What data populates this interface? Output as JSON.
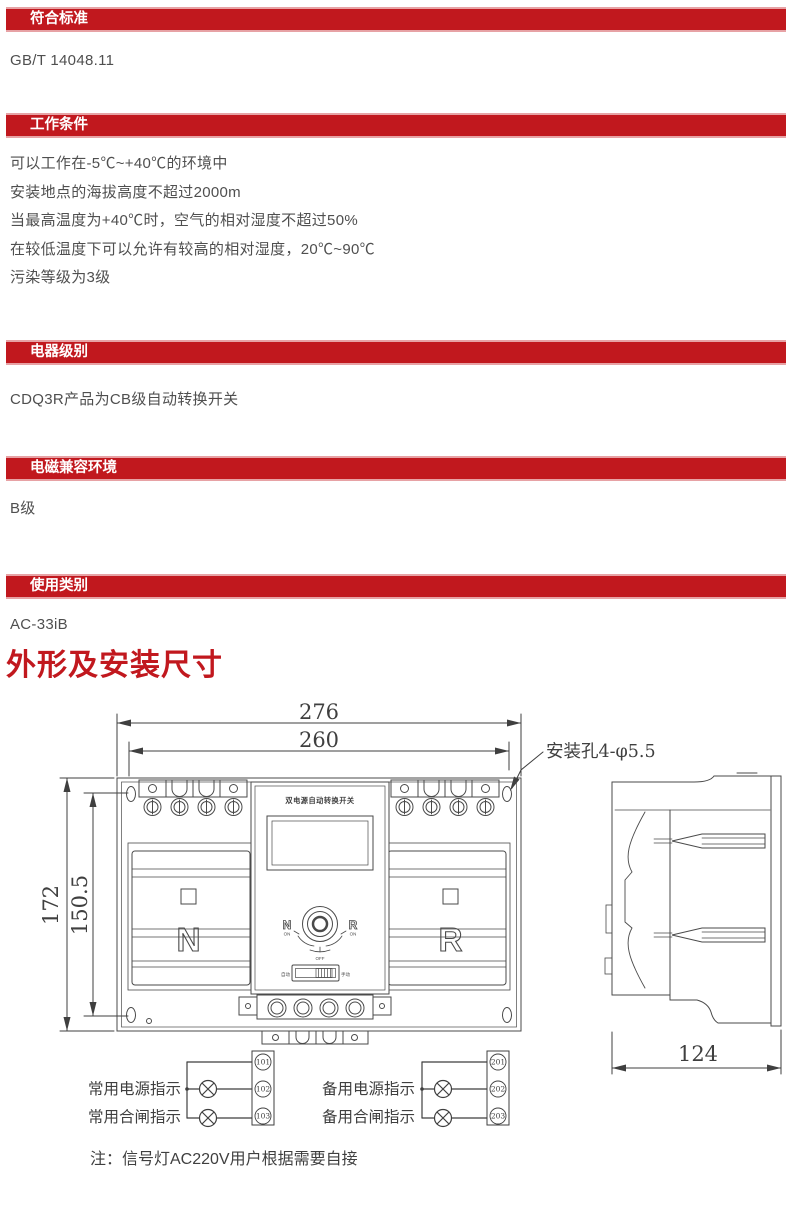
{
  "colors": {
    "accent_red": "#c1181e",
    "bar_edge": "#e7a2a5",
    "text_gray": "#4f4f4f",
    "line_gray": "#4a4a4a"
  },
  "sections": [
    {
      "label": "符合标准",
      "lines": [
        "GB/T 14048.11"
      ]
    },
    {
      "label": "工作条件",
      "lines": [
        "可以工作在-5℃~+40℃的环境中",
        "安装地点的海拔高度不超过2000m",
        "当最高温度为+40℃时，空气的相对湿度不超过50%",
        "在较低温度下可以允许有较高的相对湿度，20℃~90℃",
        "污染等级为3级"
      ]
    },
    {
      "label": "电器级别",
      "lines": [
        "CDQ3R产品为CB级自动转换开关"
      ]
    },
    {
      "label": "电磁兼容环境",
      "lines": [
        "B级"
      ]
    },
    {
      "label": "使用类别",
      "lines": [
        "AC-33iB"
      ]
    }
  ],
  "drawing_title": "外形及安装尺寸",
  "drawing": {
    "dimensions": {
      "width_outer": "276",
      "width_holes": "260",
      "height_outer": "172",
      "height_holes": "150.5",
      "depth": "124",
      "mounting_hole_label": "安装孔4-φ5.5"
    },
    "front_view": {
      "product_title": "双电源自动转换开关",
      "left_pole_letter": "N",
      "right_pole_letter": "R",
      "knob": {
        "left": "N",
        "left_sub": "ON",
        "right": "R",
        "right_sub": "ON",
        "bottom": "OFF"
      },
      "mode_switch": {
        "left": "自动",
        "right": "手动"
      }
    },
    "indicators": {
      "left": {
        "rows": [
          "常用电源指示",
          "常用合闸指示"
        ],
        "terminals": [
          "101",
          "102",
          "103"
        ]
      },
      "right": {
        "rows": [
          "备用电源指示",
          "备用合闸指示"
        ],
        "terminals": [
          "201",
          "202",
          "203"
        ]
      },
      "note": "注：信号灯AC220V用户根据需要自接"
    }
  }
}
